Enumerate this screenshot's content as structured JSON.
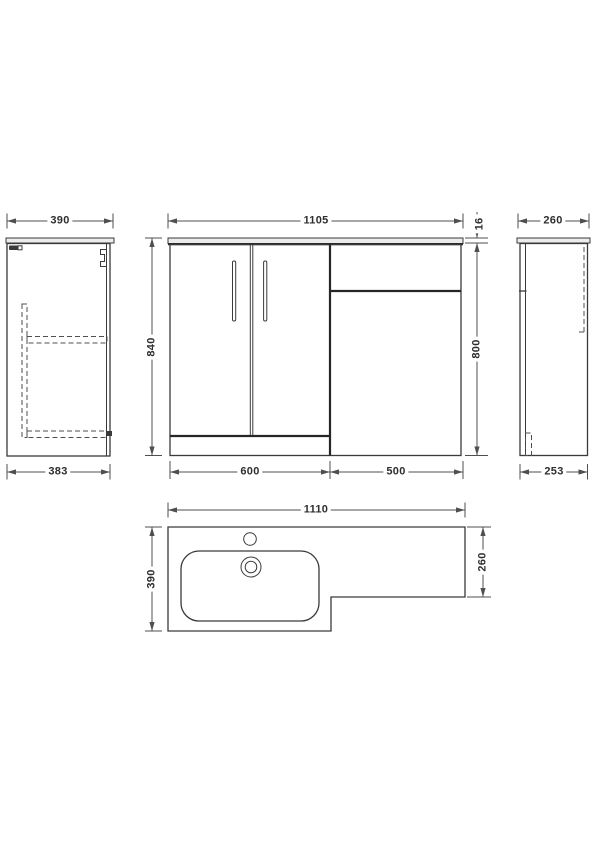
{
  "drawing": {
    "colors": {
      "background": "#ffffff",
      "object_line": "#3a3a3a",
      "dimension_line": "#4f4f4f",
      "text": "#2e2e2e",
      "counter_fill": "#ececec"
    },
    "views": {
      "side_left": {
        "top_dim": "390",
        "bottom_dim": "383"
      },
      "front": {
        "width_dim": "1105",
        "counter_thickness_dim": "16",
        "height_overall_dim": "840",
        "height_cabinet_dim": "800",
        "vanity_width_dim": "600",
        "wc_unit_width_dim": "500"
      },
      "side_right": {
        "top_dim": "260",
        "bottom_dim": "253"
      },
      "plan": {
        "width_dim": "1110",
        "left_depth_dim": "390",
        "right_depth_dim": "260"
      }
    }
  }
}
